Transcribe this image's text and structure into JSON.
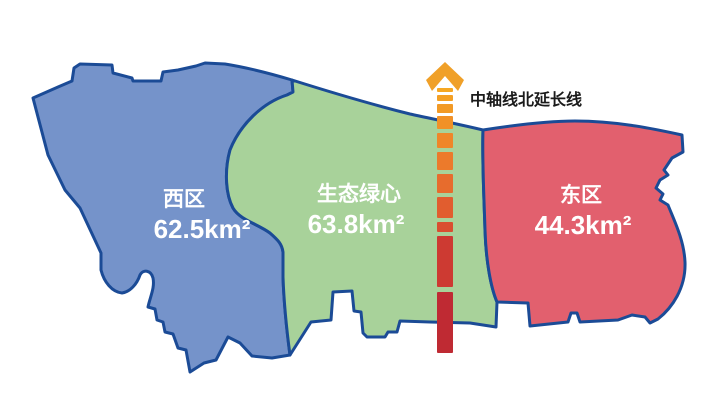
{
  "map": {
    "background": "#ffffff",
    "border_color": "#1b4b96"
  },
  "regions": {
    "west": {
      "name": "西区",
      "area": "62.5km²",
      "color": "#7593ca"
    },
    "center": {
      "name": "生态绿心",
      "area": "63.8km²",
      "color": "#a8d29a"
    },
    "east": {
      "name": "东区",
      "area": "44.3km²",
      "color": "#e2606e"
    }
  },
  "axis": {
    "label": "中轴线北延长线",
    "label_color": "#1a1a1a",
    "arrow_color": "#f0a028",
    "segments": [
      {
        "y": 88,
        "h": 4,
        "color": "#f6a722"
      },
      {
        "y": 95,
        "h": 6,
        "color": "#f4a024"
      },
      {
        "y": 104,
        "h": 9,
        "color": "#f29a26"
      },
      {
        "y": 116,
        "h": 13,
        "color": "#f19127"
      },
      {
        "y": 133,
        "h": 15,
        "color": "#ef8629"
      },
      {
        "y": 152,
        "h": 18,
        "color": "#ec7a2b"
      },
      {
        "y": 174,
        "h": 19,
        "color": "#e76c2d"
      },
      {
        "y": 197,
        "h": 21,
        "color": "#e15d2f"
      },
      {
        "y": 222,
        "h": 10,
        "color": "#da4e31"
      },
      {
        "y": 236,
        "h": 51,
        "color": "#cd3a32"
      },
      {
        "y": 292,
        "h": 61,
        "color": "#bf2a33"
      }
    ]
  }
}
